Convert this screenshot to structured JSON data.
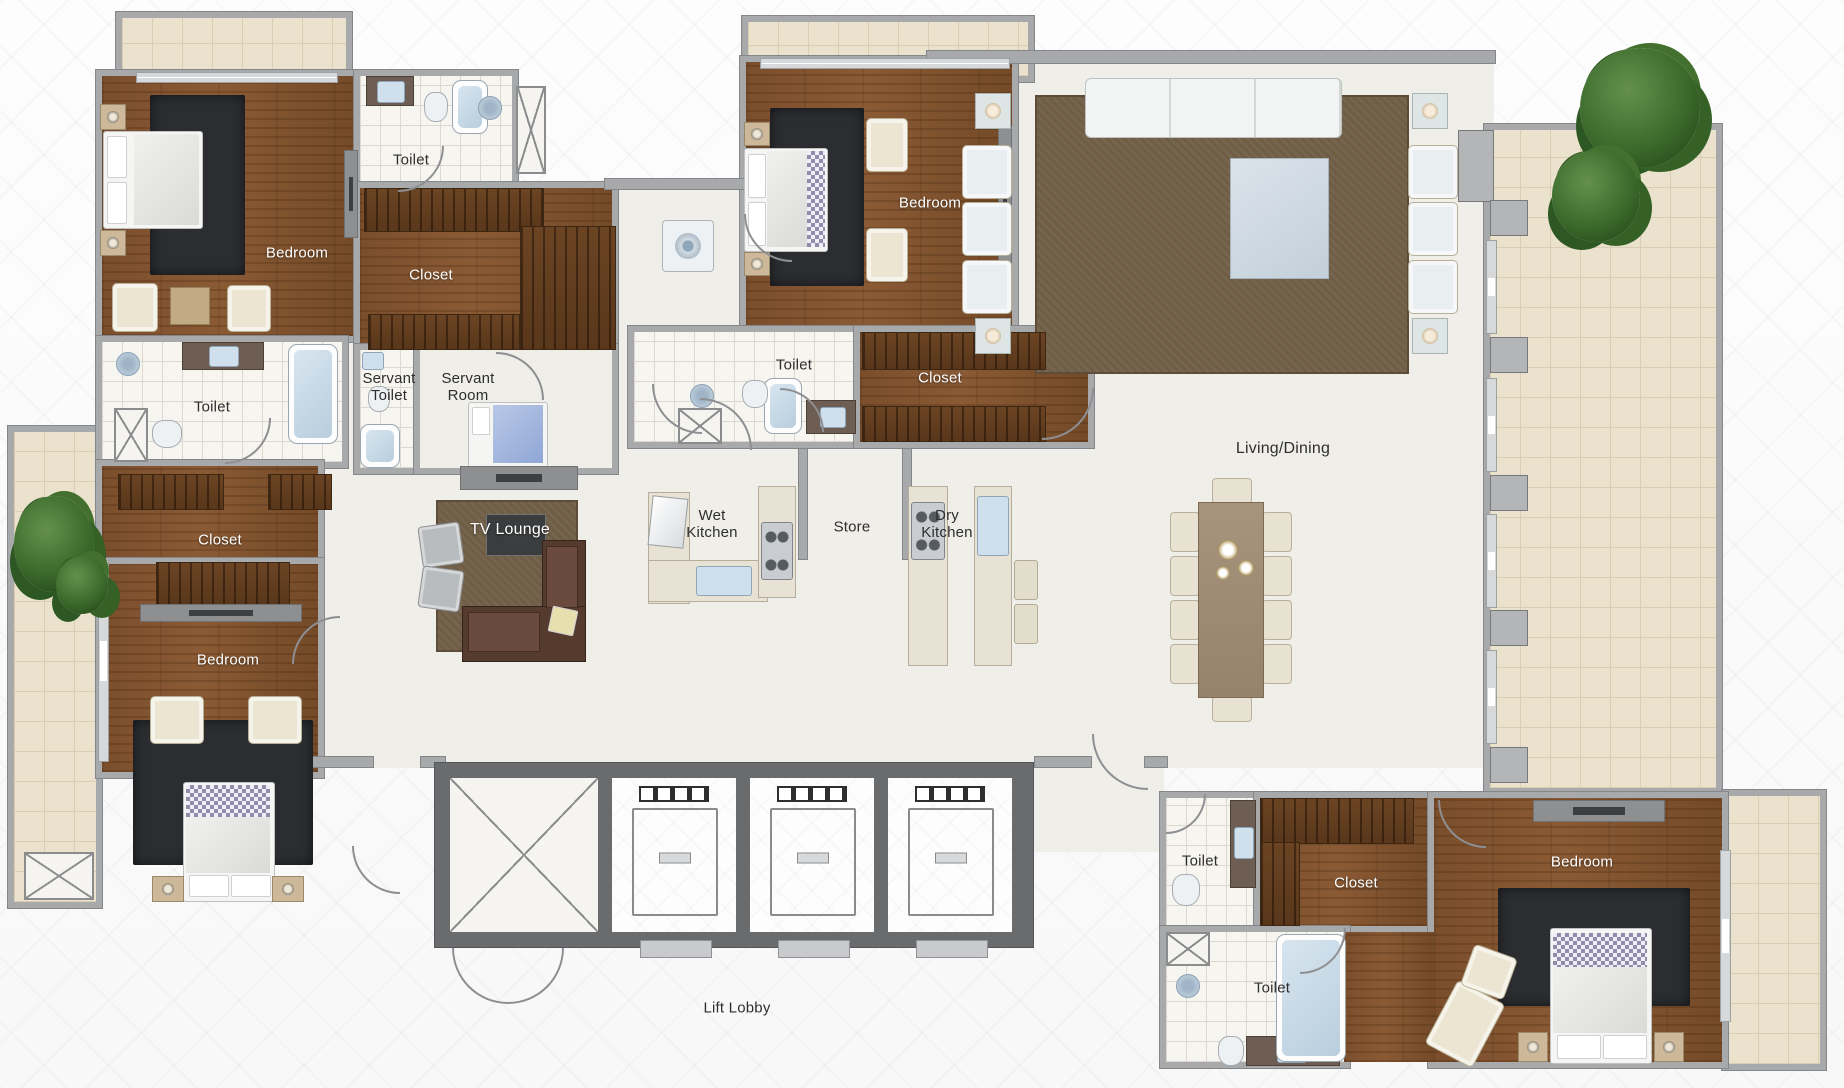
{
  "title": "Apartment Floor Plan",
  "colors": {
    "wall": "#a8a9ab",
    "wall_dark": "#6a6b6d",
    "wood": "#7b4e2c",
    "marble": "#f0eee9",
    "tile": "#f7f5f0",
    "balcony_tile": "#ebe2cd",
    "rug_dark": "#2b2d31",
    "rug_brown": "#6f5d45",
    "cream": "#ece5d1",
    "counter": "#e7e2d3",
    "water_blue": "#cfe0ec",
    "plant_green": "#3c6a2c",
    "sofa_brown": "#553a2e"
  },
  "labels": {
    "bedroom": "Bedroom",
    "toilet": "Toilet",
    "closet": "Closet",
    "servant_toilet": "Servant Toilet",
    "servant_room": "Servant Room",
    "tv_lounge": "TV Lounge",
    "wet_kitchen": "Wet Kitchen",
    "store": "Store",
    "dry_kitchen": "Dry Kitchen",
    "living_dining": "Living/Dining",
    "lift_lobby": "Lift Lobby"
  },
  "room_list": [
    "Bedroom",
    "Toilet",
    "Closet",
    "Bedroom",
    "Toilet",
    "Closet",
    "Servant Toilet",
    "Servant Room",
    "TV Lounge",
    "Wet Kitchen",
    "Store",
    "Dry Kitchen",
    "Bedroom",
    "Toilet",
    "Closet",
    "Living/Dining",
    "Lift Lobby",
    "Toilet",
    "Closet",
    "Bedroom",
    "Toilet"
  ]
}
